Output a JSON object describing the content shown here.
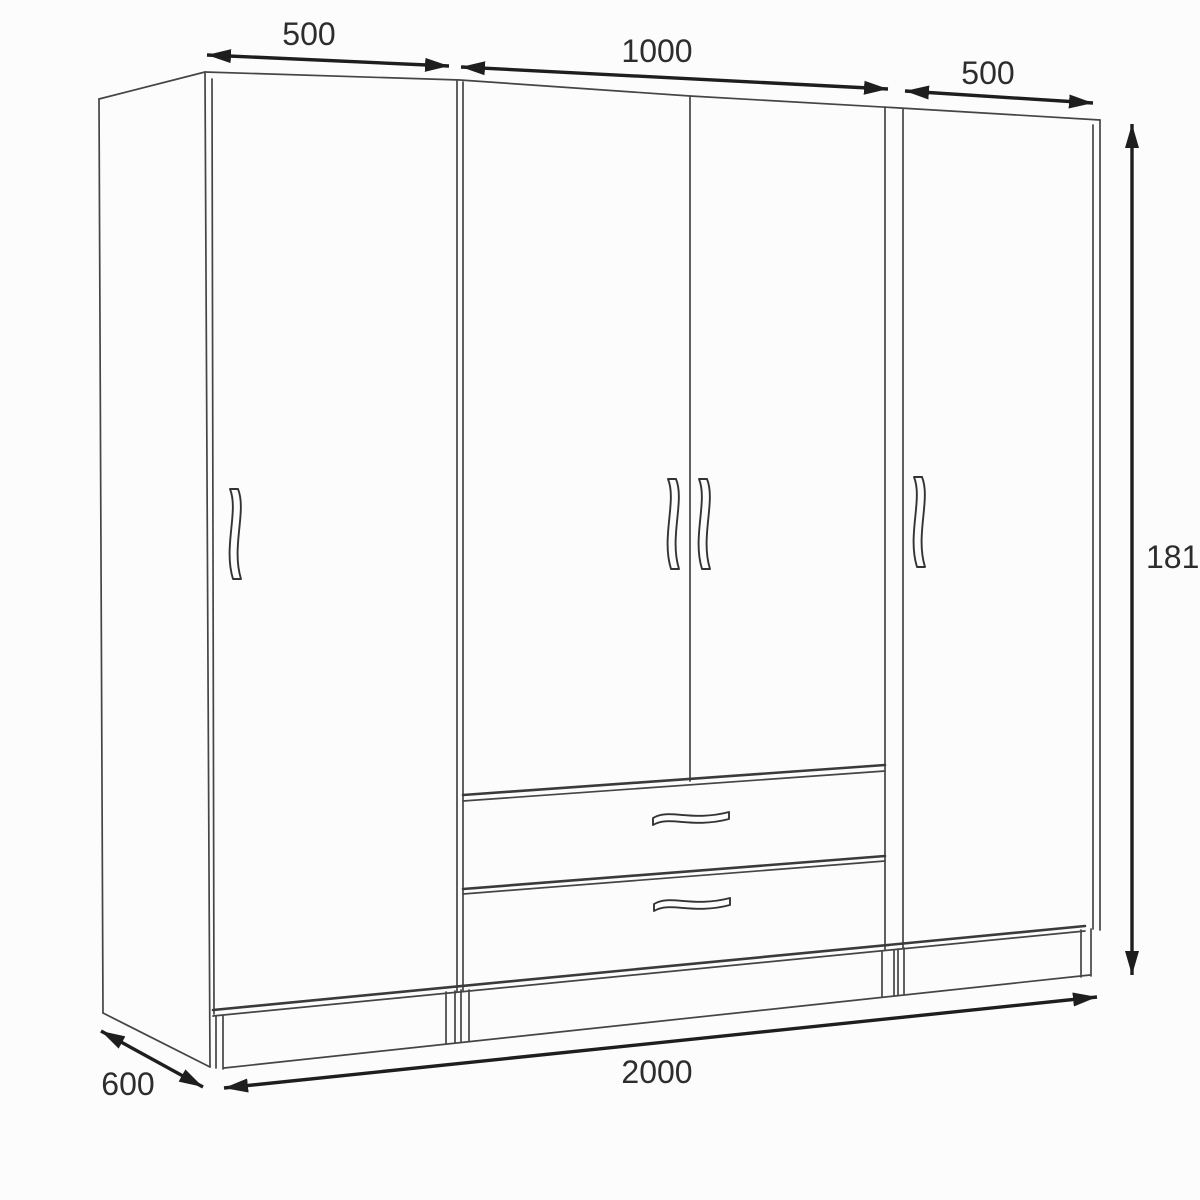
{
  "diagram": {
    "kind": "furniture dimension drawing",
    "subject": "four-door wardrobe with two drawers, perspective line drawing",
    "colors": {
      "background": "#fcfcfc",
      "furniture_line": "#454545",
      "dimension_line": "#1e1e1e",
      "label_text": "#2d2d2d"
    },
    "labels": {
      "top_left_width": "500",
      "top_middle_width": "1000",
      "top_right_width": "500",
      "height": "1810",
      "total_width": "2000",
      "depth": "600"
    }
  }
}
